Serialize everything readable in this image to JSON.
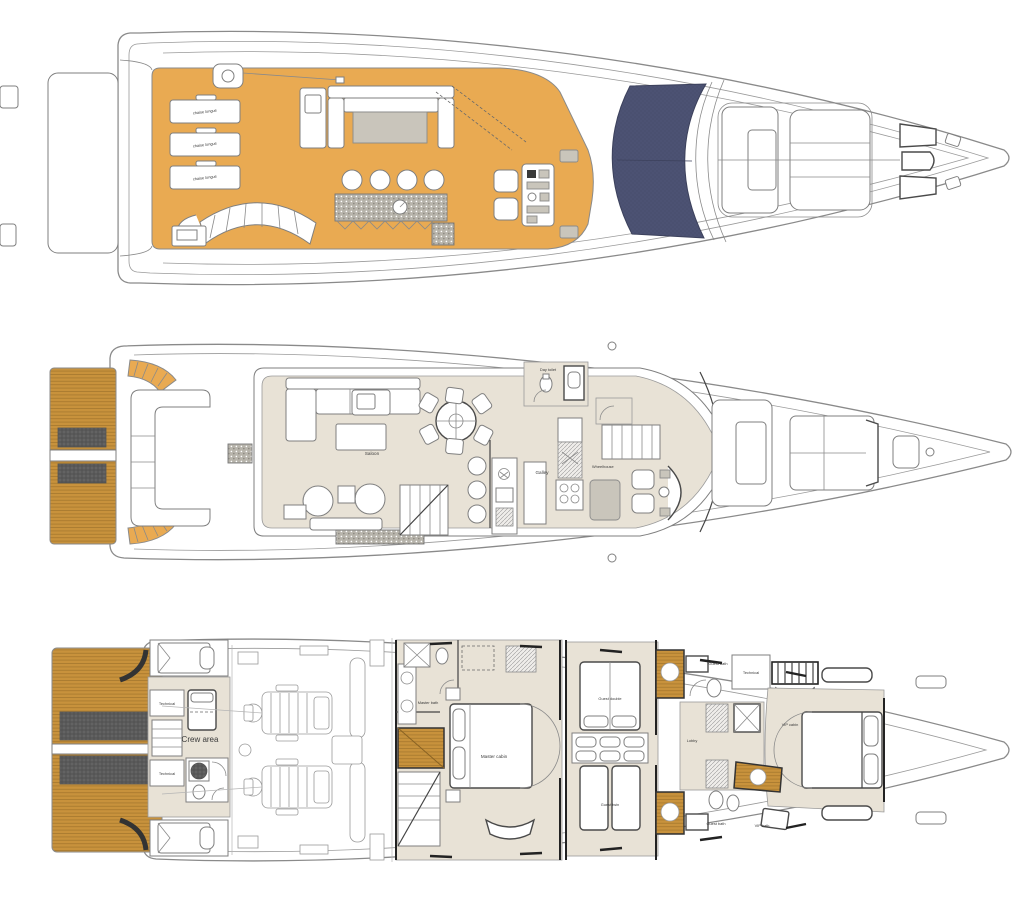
{
  "diagram": {
    "type": "yacht-deck-plans",
    "deck_count": 3
  },
  "colors": {
    "deck": "#e9aa52",
    "teak": "#c8923c",
    "teak_line": "#a1742c",
    "canvas": "#4a5070",
    "interior": "#e8e2d6",
    "furniture": "#c9c5bb",
    "outline": "#8a8a8a",
    "wall": "#222222",
    "background": "#ffffff"
  },
  "labels": {
    "chaise_longue": "chaise longue",
    "saloon": "Saloon",
    "galley": "Galley",
    "wheelhouse": "Wheelhouse",
    "day_toilet": "Day toilet",
    "crew_area": "Crew area",
    "technical": "Technical",
    "master_bath": "Master bath",
    "master_cabin": "Master cabin",
    "guest_double": "Guest double",
    "guest_twin": "Guest twin",
    "lobby": "Lobby",
    "guest_bath": "Guest bath",
    "vip_cabin": "VIP cabin",
    "vip_bath": "VIP bath"
  }
}
